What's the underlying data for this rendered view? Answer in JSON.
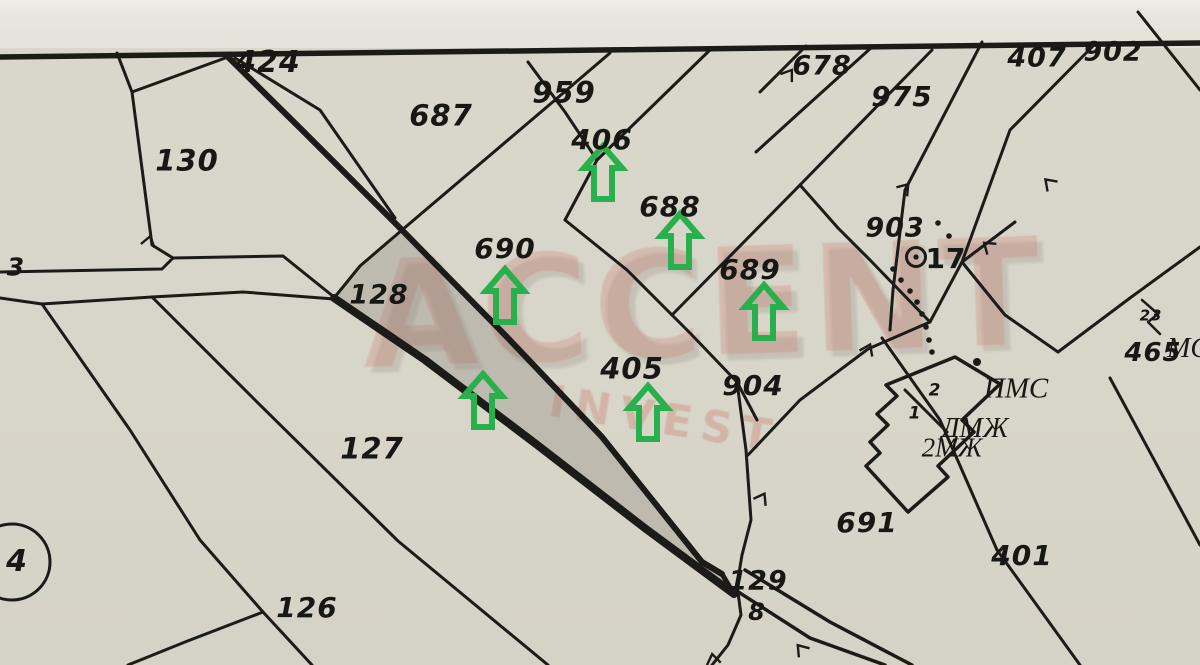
{
  "map": {
    "description": "Scanned cadastral plan with highlighted parcel strip and green marker arrows",
    "background_color": "#d9d6cb",
    "line_color": "#1b1b18",
    "highlight_fill": "rgba(125,120,110,0.28)",
    "arrow_color": "#27b04b",
    "watermark": {
      "line1": "ACCENT",
      "line2": "INVEST",
      "color": "rgba(199,106,94,0.3)"
    },
    "labels": [
      {
        "t": "424",
        "x": 268,
        "y": 63,
        "fs": 30
      },
      {
        "t": "687",
        "x": 441,
        "y": 116,
        "fs": 29
      },
      {
        "t": "959",
        "x": 564,
        "y": 93,
        "fs": 29
      },
      {
        "t": "406",
        "x": 602,
        "y": 140,
        "fs": 28
      },
      {
        "t": "678",
        "x": 822,
        "y": 66,
        "fs": 27
      },
      {
        "t": "975",
        "x": 902,
        "y": 97,
        "fs": 28
      },
      {
        "t": "407",
        "x": 1037,
        "y": 58,
        "fs": 27
      },
      {
        "t": "902",
        "x": 1113,
        "y": 52,
        "fs": 27
      },
      {
        "t": "130",
        "x": 187,
        "y": 161,
        "fs": 29
      },
      {
        "t": "688",
        "x": 670,
        "y": 207,
        "fs": 28
      },
      {
        "t": "903",
        "x": 895,
        "y": 228,
        "fs": 27
      },
      {
        "t": "17",
        "x": 946,
        "y": 259,
        "fs": 28,
        "it": false
      },
      {
        "t": "690",
        "x": 505,
        "y": 249,
        "fs": 28
      },
      {
        "t": "689",
        "x": 750,
        "y": 270,
        "fs": 28
      },
      {
        "t": "3",
        "x": 16,
        "y": 267,
        "fs": 25
      },
      {
        "t": "128",
        "x": 379,
        "y": 295,
        "fs": 27
      },
      {
        "t": "465",
        "x": 1153,
        "y": 353,
        "fs": 26
      },
      {
        "t": "МС",
        "x": 1188,
        "y": 349,
        "fs": 28,
        "serif": true
      },
      {
        "t": "23",
        "x": 1151,
        "y": 316,
        "fs": 15
      },
      {
        "t": "405",
        "x": 632,
        "y": 369,
        "fs": 29
      },
      {
        "t": "904",
        "x": 753,
        "y": 386,
        "fs": 28
      },
      {
        "t": "ПМС",
        "x": 1016,
        "y": 389,
        "fs": 29,
        "serif": true
      },
      {
        "t": "ДМЖ",
        "x": 975,
        "y": 429,
        "fs": 28,
        "serif": true
      },
      {
        "t": "2МЖ",
        "x": 952,
        "y": 448,
        "fs": 27,
        "serif": true
      },
      {
        "t": "127",
        "x": 372,
        "y": 449,
        "fs": 29
      },
      {
        "t": "691",
        "x": 867,
        "y": 523,
        "fs": 28
      },
      {
        "t": "401",
        "x": 1022,
        "y": 556,
        "fs": 28
      },
      {
        "t": "126",
        "x": 307,
        "y": 608,
        "fs": 28
      },
      {
        "t": "129",
        "x": 758,
        "y": 581,
        "fs": 27
      },
      {
        "t": "8",
        "x": 757,
        "y": 612,
        "fs": 24
      },
      {
        "t": "2",
        "x": 935,
        "y": 391,
        "fs": 17
      },
      {
        "t": "1",
        "x": 915,
        "y": 414,
        "fs": 17
      },
      {
        "t": "4",
        "x": 17,
        "y": 562,
        "fs": 30
      }
    ],
    "arrows": [
      [
        603,
        173
      ],
      [
        680,
        241
      ],
      [
        764,
        312
      ],
      [
        505,
        296
      ],
      [
        483,
        401
      ],
      [
        648,
        413
      ]
    ],
    "survey_dots": [
      [
        938,
        223
      ],
      [
        949,
        236
      ],
      [
        893,
        269
      ],
      [
        901,
        280
      ],
      [
        910,
        291
      ],
      [
        917,
        302
      ],
      [
        922,
        314
      ],
      [
        926,
        327
      ],
      [
        929,
        340
      ],
      [
        932,
        352
      ]
    ],
    "survey_point_17": {
      "cx": 916,
      "cy": 257,
      "r": 9.5
    },
    "circled_point_4": {
      "cx": 12,
      "cy": 562,
      "r": 38
    }
  }
}
